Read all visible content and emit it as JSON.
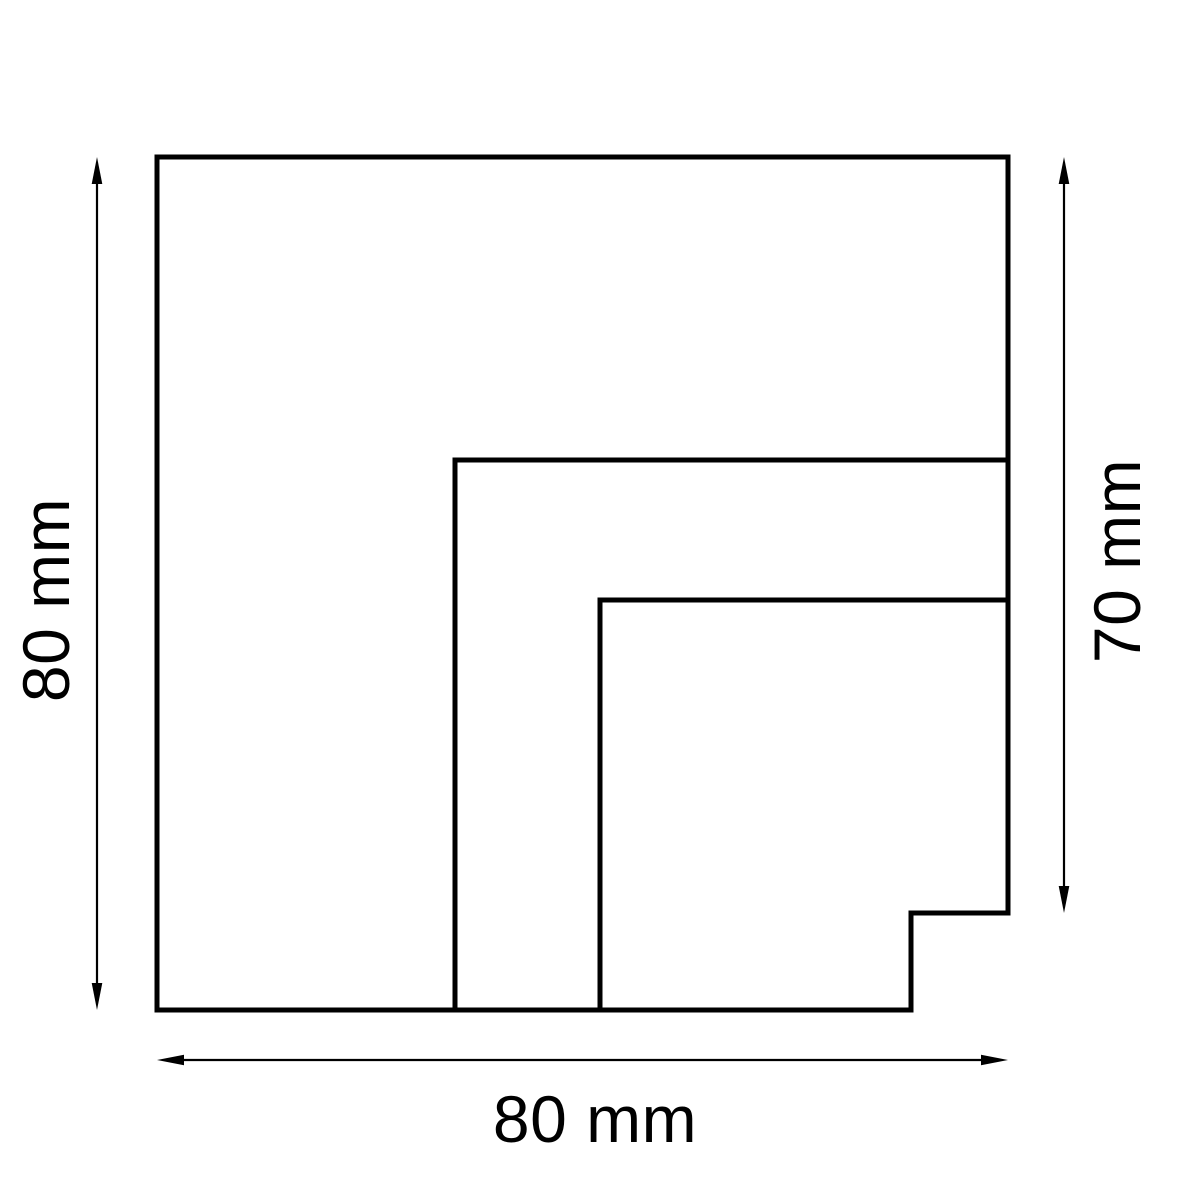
{
  "drawing": {
    "kind": "technical-dimension-diagram",
    "background": "#ffffff",
    "line_color": "#000000",
    "dimensions": {
      "left": {
        "label": "80 mm",
        "value": 80,
        "unit": "mm",
        "orientation": "vertical"
      },
      "right": {
        "label": "70 mm",
        "value": 70,
        "unit": "mm",
        "orientation": "vertical"
      },
      "bottom": {
        "label": "80 mm",
        "value": 80,
        "unit": "mm",
        "orientation": "horizontal"
      }
    }
  }
}
